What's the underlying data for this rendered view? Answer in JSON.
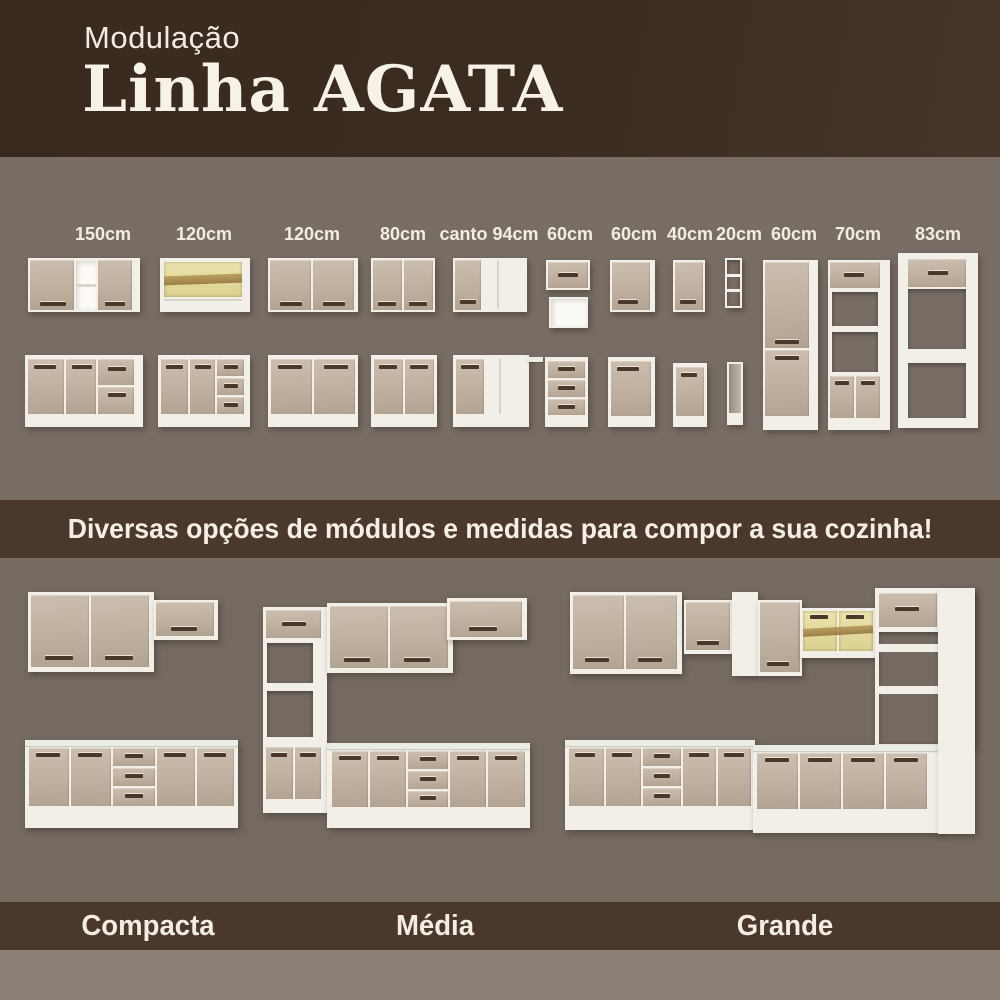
{
  "header": {
    "kicker": "Modulação",
    "title": "Linha AGATA"
  },
  "banner": {
    "text": "Diversas opções de módulos e medidas para compor a sua cozinha!"
  },
  "modules": {
    "columns": [
      {
        "label": "150cm",
        "upper": "two-door-with-open-shelf",
        "base": "two-door-two-drawer"
      },
      {
        "label": "120cm",
        "upper": "glass-door",
        "base": "two-door-three-drawer"
      },
      {
        "label": "120cm",
        "upper": "two-door",
        "base": "two-door"
      },
      {
        "label": "80cm",
        "upper": "two-door",
        "base": "two-door"
      },
      {
        "label": "canto 94cm",
        "upper": "corner-door",
        "base": "corner-door-with-counter"
      },
      {
        "label": "60cm",
        "upper": "flap-door-and-open-niche",
        "base": "three-drawer"
      },
      {
        "label": "60cm",
        "upper": "single-door",
        "base": "single-door"
      },
      {
        "label": "40cm",
        "upper": "single-door",
        "base": "single-door"
      },
      {
        "label": "20cm",
        "upper": "open-shelf-rack",
        "base": "open-niche"
      },
      {
        "label": "60cm",
        "tall": "pantry-two-door"
      },
      {
        "label": "70cm",
        "tall": "oven-tower-open-niches"
      },
      {
        "label": "83cm",
        "tall": "fridge-surround-open-frame"
      }
    ]
  },
  "kitchens": [
    {
      "label": "Compacta"
    },
    {
      "label": "Média"
    },
    {
      "label": "Grande"
    }
  ],
  "colors": {
    "header_bg": "#3a2b20",
    "modules_bg": "#786d64",
    "banner_bg": "#4b382c",
    "kitchens_bg": "#746a60",
    "footer_band_bg": "#4b382c",
    "bottom_strip_bg": "#8b7f76",
    "text": "#f2ede4",
    "door_front": "#c2b3a3",
    "carcass_white": "#f2efe9",
    "handle": "#4a392b",
    "glass": "#e3d9a0"
  }
}
